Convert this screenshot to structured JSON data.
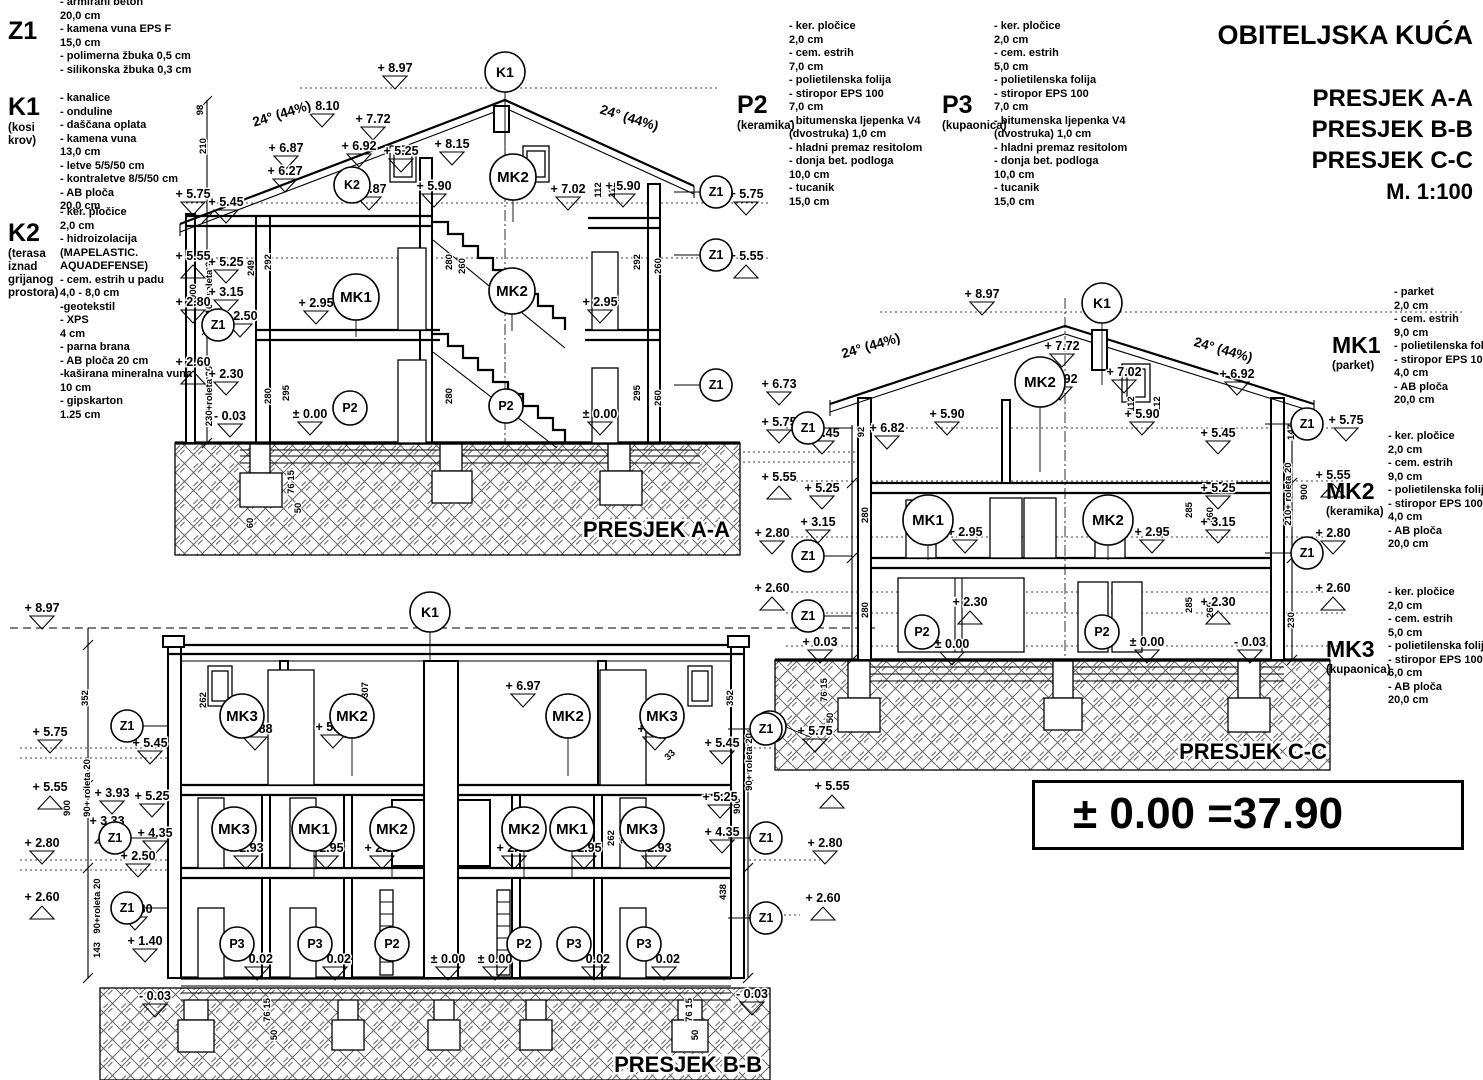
{
  "title_block": {
    "project": "OBITELJSKA KUĆA",
    "sections": [
      "PRESJEK A-A",
      "PRESJEK B-B",
      "PRESJEK C-C"
    ],
    "scale": "M. 1:100"
  },
  "datum_note": "± 0.00 =37.90",
  "legends": {
    "z1": {
      "code": "Z1",
      "name": "",
      "items": [
        "- armirani beton",
        "20,0 cm",
        "- kamena vuna EPS F",
        "15,0 cm",
        "- polimerna žbuka 0,5 cm",
        "- silikonska žbuka 0,3 cm"
      ]
    },
    "k1": {
      "code": "K1",
      "name": "(kosi krov)",
      "items": [
        "- kanalice",
        "- onduline",
        "- daščana oplata",
        "- kamena vuna",
        "13,0 cm",
        "- letve 5/5/50 cm",
        "- kontraletve 8/5/50 cm",
        "- AB ploča",
        "20,0 cm"
      ]
    },
    "k2": {
      "code": "K2",
      "name": "(terasa iznad grijanog prostora)",
      "items": [
        "- ker. pločice",
        "2,0 cm",
        "- hidroizolacija",
        "(MAPELASTIC.",
        "AQUADEFENSE)",
        "- cem. estrih u padu",
        "4,0 - 8,0 cm",
        "-geotekstil",
        "- XPS",
        "4 cm",
        "- parna brana",
        "- AB ploča 20 cm",
        "-kaširana mineralna vuna",
        "10 cm",
        "- gipskarton",
        "1.25 cm"
      ]
    },
    "p2": {
      "code": "P2",
      "name": "(keramika)",
      "items": [
        "- ker. pločice",
        "2,0 cm",
        "- cem. estrih",
        "7,0 cm",
        "- polietilenska folija",
        "- stiropor EPS 100",
        "7,0 cm",
        "- bitumenska ljepenka V4",
        "(dvostruka) 1,0 cm",
        "- hladni premaz resitolom",
        "- donja bet. podloga",
        "10,0 cm",
        "- tucanik",
        "15,0 cm"
      ]
    },
    "p3": {
      "code": "P3",
      "name": "(kupaonica)",
      "items": [
        "- ker. pločice",
        "2,0 cm",
        "- cem. estrih",
        "5,0 cm",
        "- polietilenska folija",
        "- stiropor EPS 100",
        "7,0 cm",
        "- bitumenska ljepenka V4",
        "(dvostruka) 1,0 cm",
        "- hladni premaz resitolom",
        "- donja bet. podloga",
        "10,0 cm",
        "- tucanik",
        "15,0 cm"
      ]
    },
    "mk1": {
      "code": "MK1",
      "name": "(parket)",
      "items": [
        "- parket",
        "2,0 cm",
        "- cem. estrih",
        "9,0 cm",
        "- polietilenska folija",
        "- stiropor EPS 100",
        "4,0 cm",
        "- AB ploča",
        "20,0 cm"
      ]
    },
    "mk2": {
      "code": "MK2",
      "name": "(keramika)",
      "items": [
        "- ker. pločice",
        "2,0 cm",
        "- cem. estrih",
        "9,0 cm",
        "- polietilenska folija",
        "- stiropor EPS 100",
        "4,0 cm",
        "- AB ploča",
        "20,0 cm"
      ]
    },
    "mk3": {
      "code": "MK3",
      "name": "(kupaonica)",
      "items": [
        "- ker. pločice",
        "2,0 cm",
        "- cem. estrih",
        "5,0 cm",
        "- polietilenska folija",
        "- stiropor EPS 100",
        "6,0 cm",
        "- AB ploča",
        "20,0 cm"
      ]
    }
  },
  "drawing": {
    "section_labels": [
      [
        "PRESJEK A-A",
        730,
        537
      ],
      [
        "PRESJEK B-B",
        762,
        1072
      ],
      [
        "PRESJEK C-C",
        1327,
        759
      ]
    ],
    "roof_labels": [
      [
        "24° (44%)",
        283,
        118,
        -17
      ],
      [
        "24° (44%)",
        628,
        122,
        17
      ],
      [
        "24° (44%)",
        872,
        350,
        -16
      ],
      [
        "24° (44%)",
        1222,
        354,
        16
      ]
    ],
    "markers": [
      [
        "+ 8.97",
        395,
        72,
        "d"
      ],
      [
        "+ 8.10",
        322,
        110,
        "d"
      ],
      [
        "+ 7.72",
        373,
        123,
        "d"
      ],
      [
        "+ 6.87",
        286,
        152,
        "d"
      ],
      [
        "+ 6.92",
        359,
        150,
        "d"
      ],
      [
        "+ 5.25",
        401,
        155,
        "d"
      ],
      [
        "+ 6.27",
        285,
        175,
        "d"
      ],
      [
        "+ 5.87",
        369,
        193,
        "d"
      ],
      [
        "+ 8.15",
        452,
        148,
        "d"
      ],
      [
        "+ 5.90",
        434,
        190,
        "d"
      ],
      [
        "+ 7.02",
        568,
        193,
        "d"
      ],
      [
        "+ 5.90",
        623,
        190,
        "d"
      ],
      [
        "+ 5.75",
        193,
        198,
        "d"
      ],
      [
        "+ 5.45",
        226,
        206,
        "d"
      ],
      [
        "+ 5.55",
        193,
        260,
        "u"
      ],
      [
        "+ 5.25",
        226,
        266,
        "d"
      ],
      [
        "+ 3.15",
        226,
        296,
        "d"
      ],
      [
        "+ 2.80",
        193,
        306,
        "d"
      ],
      [
        "+ 2.50",
        240,
        320,
        "d"
      ],
      [
        "+ 2.60",
        193,
        366,
        "u"
      ],
      [
        "+ 2.30",
        226,
        378,
        "d"
      ],
      [
        "- 0.03",
        230,
        420,
        "d"
      ],
      [
        "+ 2.95",
        316,
        307,
        "d"
      ],
      [
        "+ 2.95",
        600,
        306,
        "d"
      ],
      [
        "± 0.00",
        310,
        418,
        "d"
      ],
      [
        "± 0.00",
        600,
        418,
        "d"
      ],
      [
        "+ 5.75",
        746,
        198,
        "d"
      ],
      [
        "+ 5.55",
        746,
        260,
        "u"
      ],
      [
        "+ 8.97",
        982,
        298,
        "d"
      ],
      [
        "+ 7.72",
        1062,
        350,
        "d"
      ],
      [
        "+ 6.92",
        1060,
        383,
        "d"
      ],
      [
        "+ 7.02",
        1124,
        376,
        "d"
      ],
      [
        "+ 6.92",
        1237,
        378,
        "d"
      ],
      [
        "+ 6.73",
        779,
        388,
        "d"
      ],
      [
        "+ 5.75",
        779,
        426,
        "d"
      ],
      [
        "+ 5.45",
        822,
        437,
        "d"
      ],
      [
        "+ 5.55",
        779,
        481,
        "u"
      ],
      [
        "+ 5.25",
        822,
        492,
        "d"
      ],
      [
        "+ 6.82",
        887,
        432,
        "d"
      ],
      [
        "+ 5.90",
        947,
        418,
        "d"
      ],
      [
        "+ 5.90",
        1142,
        418,
        "d"
      ],
      [
        "+ 3.15",
        818,
        526,
        "d"
      ],
      [
        "+ 2.80",
        772,
        537,
        "d"
      ],
      [
        "+ 2.60",
        772,
        592,
        "u"
      ],
      [
        "+ 2.95",
        965,
        536,
        "d"
      ],
      [
        "+ 2.95",
        1152,
        536,
        "d"
      ],
      [
        "+ 2.30",
        970,
        606,
        "u"
      ],
      [
        "+ 0.03",
        820,
        646,
        "d"
      ],
      [
        "± 0.00",
        952,
        648,
        "d"
      ],
      [
        "± 0.00",
        1147,
        646,
        "d"
      ],
      [
        "- 0.03",
        1250,
        646,
        "d"
      ],
      [
        "+ 5.45",
        1218,
        437,
        "d"
      ],
      [
        "+ 5.25",
        1218,
        492,
        "d"
      ],
      [
        "+ 3.15",
        1218,
        526,
        "d"
      ],
      [
        "+ 2.30",
        1218,
        606,
        "u"
      ],
      [
        "+ 5.75",
        1346,
        424,
        "d"
      ],
      [
        "+ 5.55",
        1333,
        479,
        "u"
      ],
      [
        "+ 2.80",
        1333,
        537,
        "d"
      ],
      [
        "+ 2.60",
        1333,
        592,
        "u"
      ],
      [
        "+ 5.75",
        815,
        735,
        "d"
      ],
      [
        "+ 5.55",
        832,
        790,
        "u"
      ],
      [
        "+ 2.80",
        825,
        847,
        "d"
      ],
      [
        "+ 2.60",
        823,
        902,
        "u"
      ],
      [
        "+ 8.97",
        42,
        612,
        "d"
      ],
      [
        "+ 6.97",
        523,
        690,
        "d"
      ],
      [
        "+ 5.88",
        255,
        733,
        "d"
      ],
      [
        "+ 5.90",
        333,
        731,
        "d"
      ],
      [
        "+ 5.88",
        655,
        733,
        "d"
      ],
      [
        "+ 5.75",
        50,
        736,
        "d"
      ],
      [
        "+ 5.45",
        150,
        747,
        "d"
      ],
      [
        "+ 5.55",
        50,
        791,
        "u"
      ],
      [
        "+ 3.93",
        112,
        797,
        "d"
      ],
      [
        "+ 5.25",
        152,
        800,
        "d"
      ],
      [
        "+ 3.33",
        107,
        825,
        "u"
      ],
      [
        "+ 4.35",
        155,
        837,
        "d"
      ],
      [
        "+ 2.50",
        138,
        860,
        "d"
      ],
      [
        "+ 2.80",
        42,
        847,
        "d"
      ],
      [
        "+ 2.60",
        42,
        901,
        "u"
      ],
      [
        "+ 2.30",
        135,
        913,
        "d"
      ],
      [
        "+ 1.40",
        145,
        945,
        "d"
      ],
      [
        "- 0.03",
        155,
        1000,
        "d"
      ],
      [
        "+ 2.93",
        246,
        852,
        "d"
      ],
      [
        "+ 2.95",
        326,
        852,
        "d"
      ],
      [
        "+ 2.95",
        382,
        852,
        "d"
      ],
      [
        "+ 2.95",
        514,
        852,
        "d"
      ],
      [
        "+ 2.95",
        584,
        852,
        "d"
      ],
      [
        "+ 2.93",
        654,
        852,
        "d"
      ],
      [
        "- 0.02",
        257,
        963,
        "d"
      ],
      [
        "- 0.02",
        335,
        963,
        "d"
      ],
      [
        "± 0.00",
        448,
        963,
        "d"
      ],
      [
        "± 0.00",
        495,
        963,
        "d"
      ],
      [
        "- 0.02",
        594,
        963,
        "d"
      ],
      [
        "- 0.02",
        664,
        963,
        "d"
      ],
      [
        "+ 5.45",
        722,
        747,
        "d"
      ],
      [
        "+ 5.25",
        720,
        801,
        "d"
      ],
      [
        "+ 4.35",
        722,
        836,
        "d"
      ],
      [
        "- 0.03",
        752,
        998,
        "d"
      ]
    ],
    "bubbles": [
      [
        "K1",
        505,
        72,
        20,
        0,
        85
      ],
      [
        "K2",
        352,
        185,
        18
      ],
      [
        "MK2",
        513,
        177,
        23,
        0,
        45
      ],
      [
        "MK1",
        356,
        297,
        23,
        0,
        40
      ],
      [
        "MK2",
        512,
        291,
        23,
        0,
        40
      ],
      [
        "P2",
        350,
        408,
        17
      ],
      [
        "P2",
        506,
        406,
        17
      ],
      [
        "Z1",
        218,
        325,
        16
      ],
      [
        "Z1",
        716,
        192,
        16,
        -42,
        0
      ],
      [
        "Z1",
        716,
        255,
        16,
        -42,
        0
      ],
      [
        "Z1",
        716,
        385,
        16,
        -42,
        0
      ],
      [
        "K1",
        1102,
        303,
        20,
        0,
        82
      ],
      [
        "MK2",
        1040,
        382,
        25,
        0,
        90
      ],
      [
        "MK1",
        928,
        520,
        25,
        0,
        40
      ],
      [
        "MK2",
        1108,
        520,
        25,
        0,
        40
      ],
      [
        "P2",
        922,
        632,
        17
      ],
      [
        "P2",
        1102,
        632,
        17
      ],
      [
        "Z1",
        808,
        428,
        16,
        44,
        0
      ],
      [
        "Z1",
        808,
        556,
        16,
        44,
        0
      ],
      [
        "Z1",
        808,
        616,
        16,
        44,
        0
      ],
      [
        "Z1",
        770,
        727,
        16,
        40,
        10
      ],
      [
        "Z1",
        1307,
        424,
        16,
        -42,
        0
      ],
      [
        "Z1",
        1307,
        553,
        16,
        -42,
        0
      ],
      [
        "K1",
        430,
        612,
        20,
        0,
        48
      ],
      [
        "MK3",
        242,
        716,
        22
      ],
      [
        "MK2",
        352,
        716,
        22,
        0,
        60
      ],
      [
        "MK2",
        568,
        716,
        22,
        0,
        60
      ],
      [
        "MK3",
        662,
        716,
        22
      ],
      [
        "MK3",
        234,
        829,
        22
      ],
      [
        "MK1",
        314,
        829,
        22,
        0,
        50
      ],
      [
        "MK2",
        392,
        829,
        22,
        0,
        50
      ],
      [
        "MK2",
        524,
        829,
        22,
        0,
        50
      ],
      [
        "MK1",
        572,
        829,
        22,
        0,
        50
      ],
      [
        "MK3",
        642,
        829,
        22
      ],
      [
        "P3",
        237,
        944,
        17
      ],
      [
        "P3",
        315,
        944,
        17
      ],
      [
        "P2",
        392,
        944,
        17
      ],
      [
        "P2",
        524,
        944,
        17
      ],
      [
        "P3",
        574,
        944,
        17
      ],
      [
        "P3",
        644,
        944,
        17
      ],
      [
        "Z1",
        127,
        726,
        16,
        42,
        0
      ],
      [
        "Z1",
        115,
        838,
        16,
        42,
        0
      ],
      [
        "Z1",
        127,
        908,
        16,
        42,
        0
      ],
      [
        "Z1",
        766,
        729,
        16,
        -38,
        0
      ],
      [
        "Z1",
        766,
        838,
        16,
        -38,
        0
      ],
      [
        "Z1",
        766,
        918,
        16,
        -38,
        0
      ]
    ],
    "dims": [
      [
        "98",
        203,
        110
      ],
      [
        "210",
        206,
        146
      ],
      [
        "900",
        196,
        292
      ],
      [
        "210+ roleta 20",
        212,
        288
      ],
      [
        "230+roleta 20",
        212,
        396
      ],
      [
        "249",
        254,
        268
      ],
      [
        "292",
        271,
        262
      ],
      [
        "280",
        452,
        262
      ],
      [
        "260",
        465,
        266
      ],
      [
        "292",
        640,
        262
      ],
      [
        "260",
        661,
        266
      ],
      [
        "280",
        271,
        396
      ],
      [
        "295",
        289,
        393
      ],
      [
        "280",
        452,
        396
      ],
      [
        "295",
        640,
        393
      ],
      [
        "260",
        661,
        398
      ],
      [
        "112",
        601,
        190
      ],
      [
        "112",
        615,
        190
      ],
      [
        "76 15",
        294,
        482
      ],
      [
        "50",
        301,
        508
      ],
      [
        "60",
        253,
        523
      ],
      [
        "92",
        864,
        432
      ],
      [
        "280",
        868,
        515
      ],
      [
        "285",
        1192,
        510
      ],
      [
        "260",
        1213,
        515
      ],
      [
        "280",
        868,
        610
      ],
      [
        "285",
        1192,
        605
      ],
      [
        "260",
        1213,
        610
      ],
      [
        "112",
        1134,
        404
      ],
      [
        "112",
        1160,
        404
      ],
      [
        "147",
        1294,
        432
      ],
      [
        "210+ roleta 20",
        1291,
        494
      ],
      [
        "900",
        1307,
        492
      ],
      [
        "230",
        1294,
        620
      ],
      [
        "76 15",
        827,
        690
      ],
      [
        "50",
        833,
        718
      ],
      [
        "352",
        88,
        698
      ],
      [
        "900",
        70,
        808
      ],
      [
        "90+ roleta 20",
        90,
        788
      ],
      [
        "90+roleta 20",
        100,
        906
      ],
      [
        "143",
        100,
        950
      ],
      [
        "307",
        368,
        690
      ],
      [
        "352",
        733,
        698
      ],
      [
        "90+ roleta 20",
        752,
        762
      ],
      [
        "900",
        740,
        806
      ],
      [
        "438",
        726,
        892
      ],
      [
        "33",
        672,
        757,
        -45
      ],
      [
        "282",
        224,
        838
      ],
      [
        "295",
        242,
        836
      ],
      [
        "295",
        627,
        836
      ],
      [
        "262",
        614,
        838
      ],
      [
        "262",
        206,
        700
      ],
      [
        "76 15",
        270,
        1010
      ],
      [
        "50",
        277,
        1035
      ],
      [
        "76 15",
        692,
        1010
      ],
      [
        "50",
        698,
        1035
      ]
    ]
  }
}
